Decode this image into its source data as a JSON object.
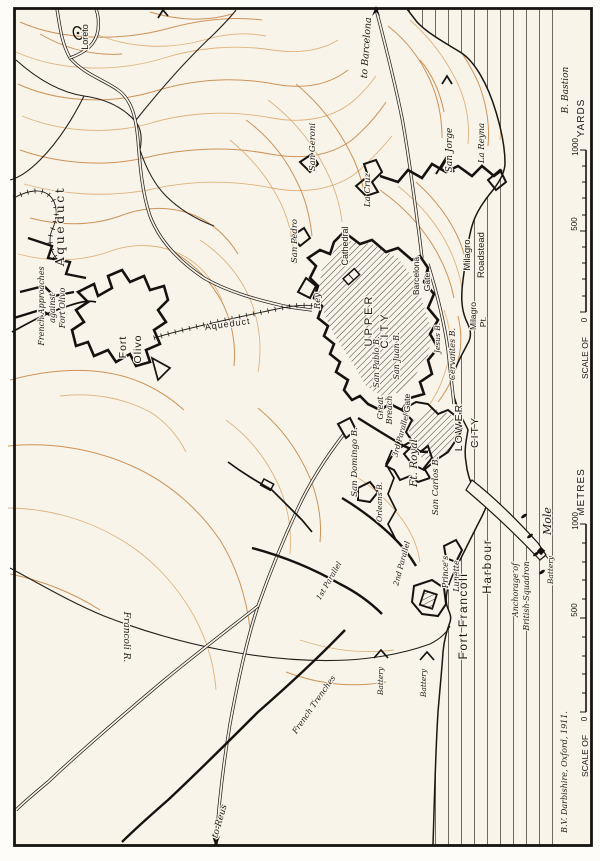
{
  "map": {
    "credit": "B.V. Darbishire, Oxford, 1911.",
    "legend_note": "B. Bastion",
    "colors": {
      "ink": "#1d1813",
      "contour": "#c6813f",
      "paper": "#f8f4ea",
      "sea_line": "#4a443e"
    },
    "scales": {
      "yards": {
        "title": "YARDS",
        "scale_label": "SCALE OF",
        "tick_0": "0",
        "tick_500": "500",
        "tick_1000": "1000"
      },
      "metres": {
        "title": "METRES",
        "scale_label": "SCALE OF",
        "tick_0": "0",
        "tick_500": "500",
        "tick_1000": "1000"
      }
    },
    "labels": {
      "loreto": "Loreto",
      "to_barcelona": "to Barcelona",
      "to_reus": "to Reus",
      "aqueduct_main": "Aqueduct",
      "aqueduct_city": "Aqueduct",
      "french_approaches_1": "French Approaches",
      "french_approaches_2": "against",
      "french_approaches_3": "Fort Olivo",
      "fort_olivo_1": "Fort",
      "fort_olivo_2": "Olivo",
      "san_geroni": "San Geroni",
      "san_pedro": "San Pedro",
      "rey": "Rey",
      "la_cruz": "La Cruz",
      "san_jorge": "San Jorge",
      "la_reyna": "La Reyna",
      "cathedral": "Cathedral",
      "upper_1": "UPPER",
      "upper_2": "CITY",
      "barcelona_gate_1": "Barcelona",
      "barcelona_gate_2": "Gate",
      "milagro_roadstead_1": "Milagro",
      "milagro_roadstead_2": "Roadstead",
      "milagro_pt_1": "Milagro",
      "milagro_pt_2": "Pt.",
      "cervantes": "Cervantes B.",
      "jesus": "Jesus B.",
      "san_juan": "San Juan B.",
      "san_pablo": "San Pablo B.",
      "great_breach_1": "Great",
      "great_breach_2": "Breach",
      "gate": "Gate",
      "third_parallel": "3rd Parallel",
      "second_parallel": "2nd Parallel",
      "first_parallel": "1st Parallel",
      "ft_royal": "Ft. Royal",
      "orleans": "Orleans B.",
      "san_carlos": "San Carlos B.",
      "san_domingo": "San Domingo B.",
      "lower_1": "LOWER",
      "lower_2": "CITY",
      "princes_lunette_1": "Prince's",
      "princes_lunette_2": "Lunette",
      "harbour": "Harbour",
      "mole": "Mole",
      "battery_mole": "Battery",
      "battery_1": "Battery",
      "battery_2": "Battery",
      "anchorage_1": "Anchorage of",
      "anchorage_2": "British Squadron",
      "fort_francoli": "Fort Francoli",
      "francoli_r": "Francoli R.",
      "french_trenches": "French Trenches"
    }
  }
}
